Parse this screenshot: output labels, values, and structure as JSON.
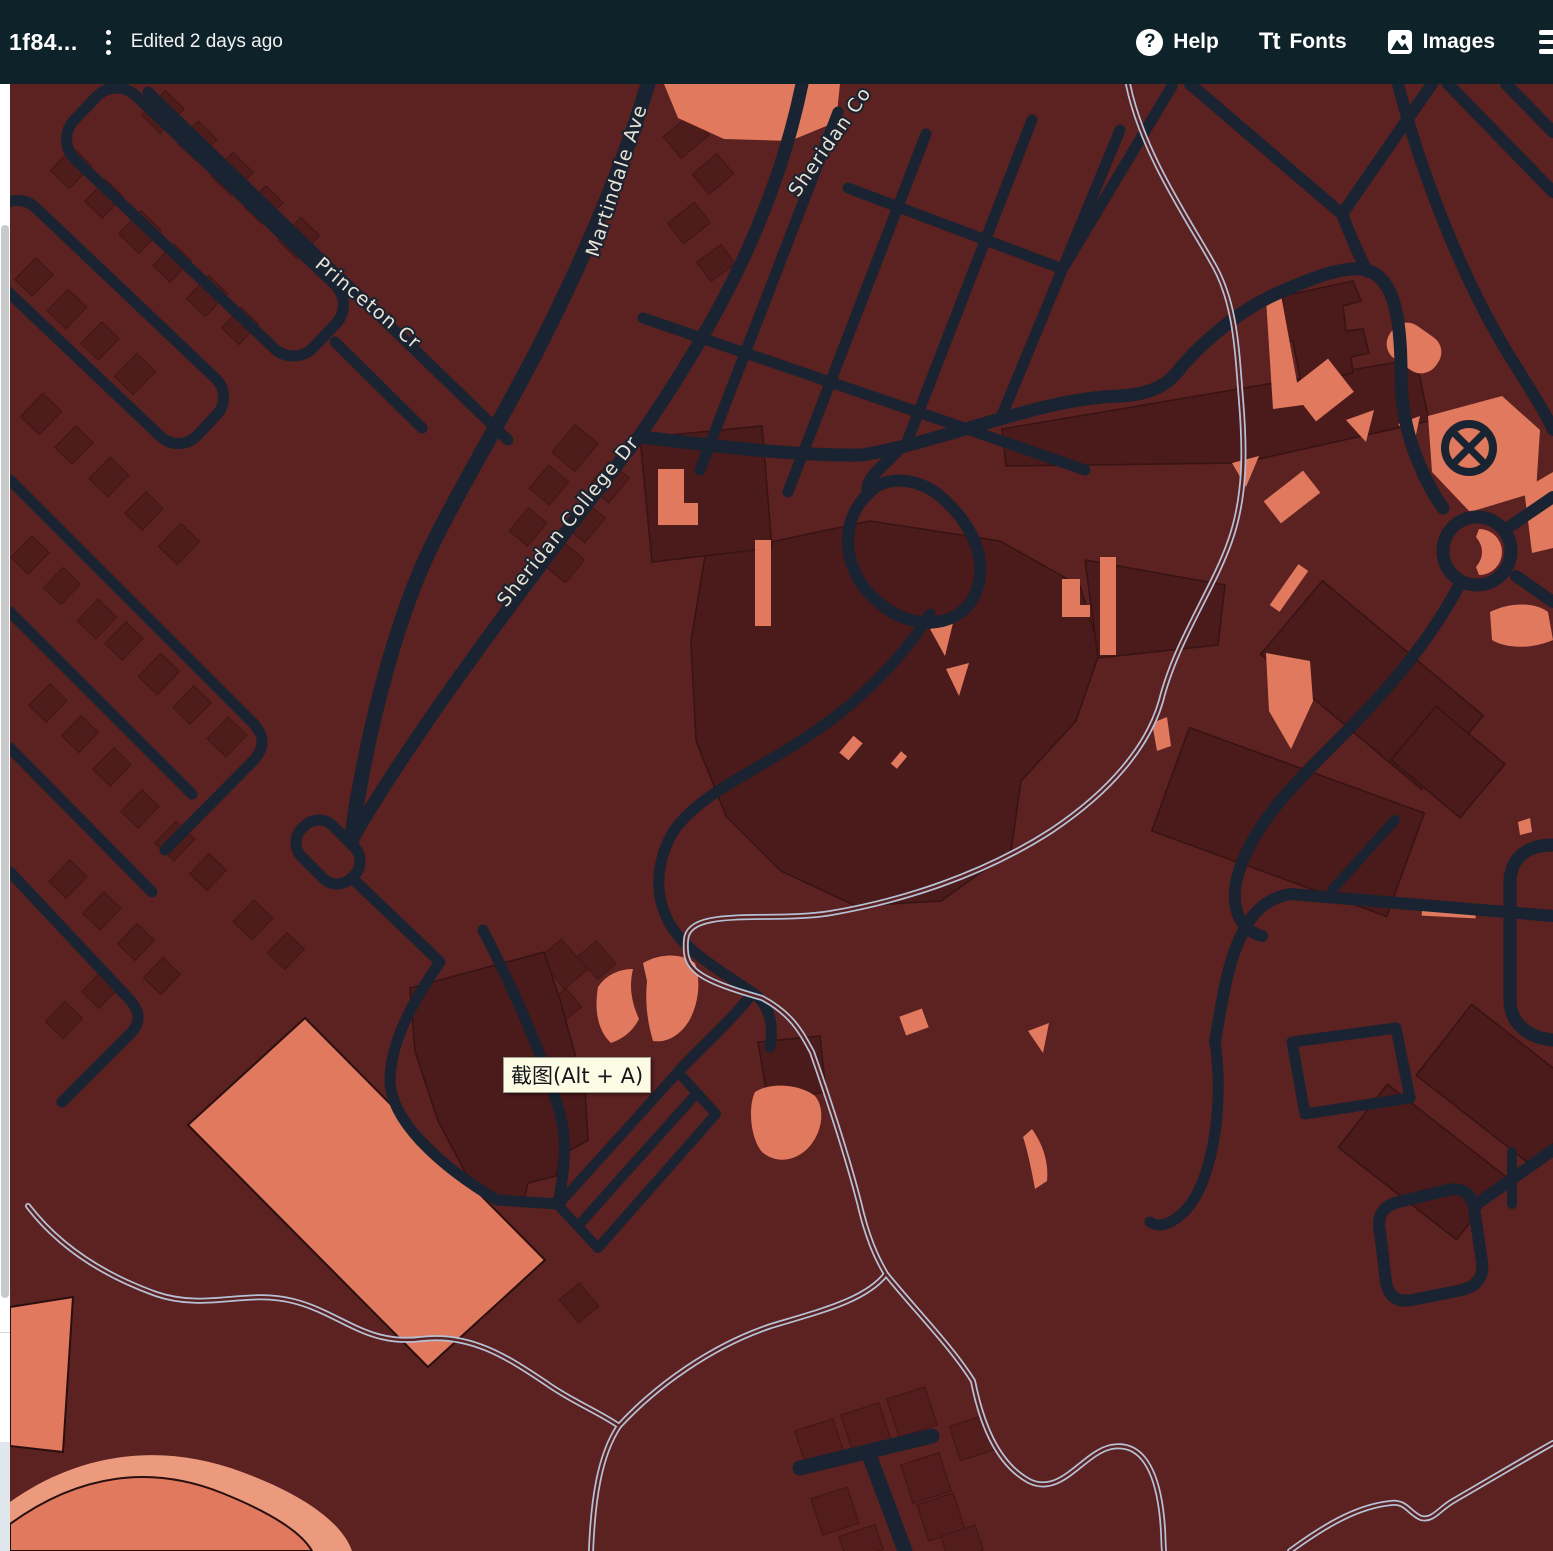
{
  "toolbar": {
    "title_clipped_prefix": "0",
    "title": "1f84...",
    "edited": "Edited 2 days ago",
    "help": {
      "icon": "?",
      "label": "Help"
    },
    "fonts": {
      "icon": "Tt",
      "label": "Fonts"
    },
    "images": {
      "label": "Images"
    }
  },
  "map": {
    "street_labels": {
      "martindale": "Martindale Ave",
      "princeton": "Princeton Cr",
      "sheridan_full": "Sheridan College Dr",
      "sheridan_cut": "Sheridan Co"
    },
    "tooltip": "截图(Alt + A)"
  },
  "colors": {
    "toolbar_bg": "#0e2229",
    "land": "#5c2121",
    "building": "#4f1c1c",
    "campus_building": "#4b1a1a",
    "road": "#1a2331",
    "accent_salmon": "#e0795d",
    "accent_salmon_light": "#ec9a7e",
    "water": "#b6c0d5",
    "label_text": "#eae3d3",
    "tooltip_bg": "#fcfbe4",
    "scrollbar_thumb": "#c7c9cb"
  }
}
